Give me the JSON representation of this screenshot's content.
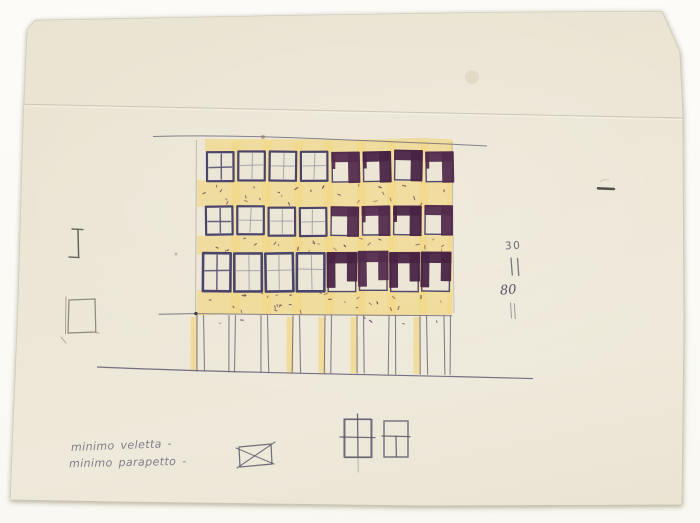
{
  "scan": {
    "bg": "#fbfaf6",
    "paper": "#ece6d6"
  },
  "colors": {
    "ink": "#45406a",
    "ink_soft": "#6b6678",
    "marker": "#4e2746",
    "marker_alt": "#532b4c",
    "marker_deep": "#482344",
    "yellow": "#f1d784",
    "pencil": "#848072",
    "pencil_dark": "#5f5c52",
    "hand": "#807c8b",
    "dim": "#6d6a75"
  },
  "notes": {
    "line1": "minimo veletta -",
    "line2": "minimo parapetto -"
  },
  "dims": {
    "top": "30",
    "bottom": "80"
  },
  "facade": {
    "left": 196,
    "right": 452,
    "first_x": 207,
    "pitch": 31.3,
    "win_w": 26.5,
    "cols": 8,
    "filled_from": 4,
    "rows": [
      {
        "y": 152,
        "h": 29,
        "xoff": 0
      },
      {
        "y": 207,
        "h": 28,
        "xoff": -1
      },
      {
        "y": 253,
        "h": 38,
        "xoff": -4
      }
    ],
    "bands": [
      [
        139,
        14
      ],
      [
        181,
        27
      ],
      [
        235,
        19
      ],
      [
        290,
        25
      ]
    ],
    "speckle_zones": [
      [
        184,
        204,
        26
      ],
      [
        238,
        251,
        22
      ],
      [
        293,
        312,
        30
      ],
      [
        316,
        324,
        6
      ]
    ],
    "top_line": {
      "x1": 153,
      "y1": 136.5,
      "x2": 487,
      "y2": 146
    },
    "beam_y": 314,
    "beam_ext_x": 159,
    "ground": {
      "x1": 97,
      "y1": 367,
      "x2": 533,
      "y2": 378.6
    },
    "pilotis": {
      "top": 315,
      "w": 6.5,
      "xs": [
        197,
        229,
        261,
        293,
        325,
        357,
        389,
        420,
        444
      ],
      "yellow": [
        1,
        0,
        0,
        1,
        1,
        1,
        0,
        1,
        0
      ]
    }
  },
  "details": {
    "left_square": {
      "x": 69,
      "y": 299,
      "w": 26,
      "h": 33
    },
    "ibeam": {
      "x": 78,
      "y": 229,
      "h": 28
    },
    "crossed_rect": {
      "x": 239,
      "y": 444,
      "w": 32,
      "h": 22
    },
    "win_a": {
      "x": 344,
      "y": 419,
      "w": 27,
      "h": 38
    },
    "win_b": {
      "x": 384,
      "y": 421,
      "w": 24,
      "h": 36
    },
    "dash": {
      "x": 598,
      "y": 188,
      "len": 16
    }
  }
}
